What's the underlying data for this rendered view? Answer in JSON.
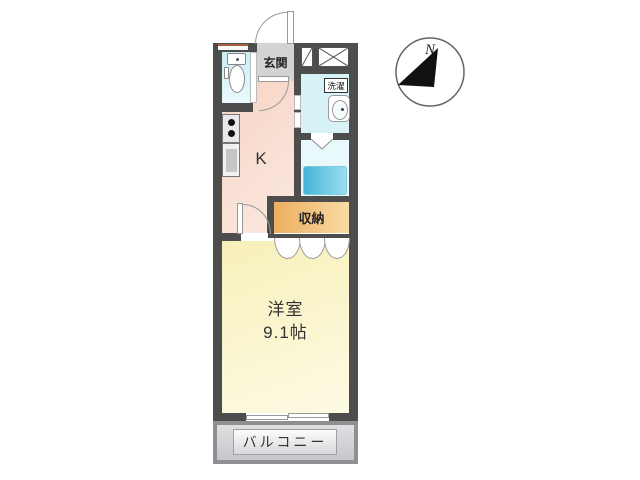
{
  "plan": {
    "rooms": {
      "entrance_label": "玄関",
      "kitchen_label": "K",
      "laundry_label": "洗濯",
      "storage_label": "収納",
      "main_room_name": "洋室",
      "main_room_size": "9.1帖",
      "balcony_label": "バルコニー"
    },
    "compass": {
      "north_label": "N"
    },
    "colors": {
      "wall": "#4d4d4d",
      "kitchen_a": "#f6d0c0",
      "kitchen_b": "#fbeae2",
      "toilet_a": "#c9edf3",
      "toilet_b": "#eafafc",
      "washroom": "#d8f3f8",
      "bathroom": "#e9f8fb",
      "bathtub_a": "#45b5d6",
      "bathtub_b": "#9addee",
      "storage_a": "#edae5e",
      "storage_b": "#f8dba5",
      "room_a": "#f7f0ba",
      "room_b": "#fdfae3",
      "genkan": "#d3d3d3",
      "balcony_frame": "#8f9094",
      "balcony_a": "#e0e0e3",
      "balcony_b": "#c7c7cb",
      "labelbox_a": "#fcfcfc",
      "labelbox_b": "#d8d8db"
    }
  }
}
